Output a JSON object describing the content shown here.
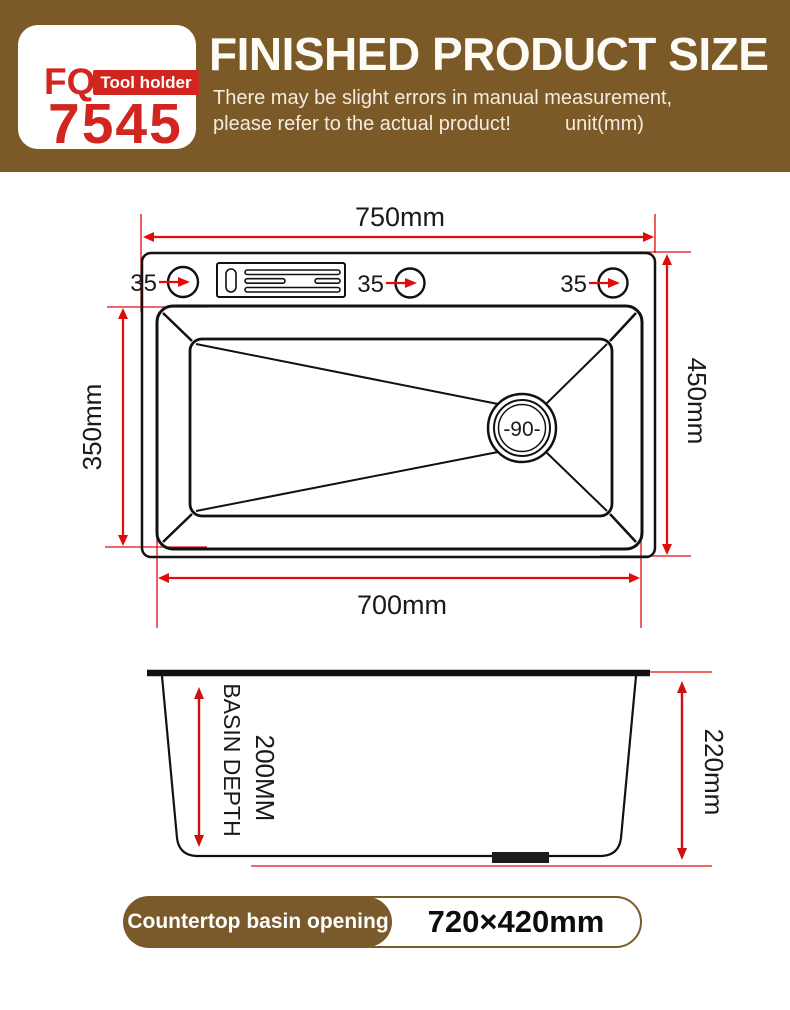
{
  "header": {
    "brand": {
      "abbr": "FQ",
      "tag": "Tool holder",
      "model": "7545"
    },
    "title": "FINISHED PRODUCT SIZE",
    "subtitle_line1": "There may be slight errors in manual measurement,",
    "subtitle_line2": "please refer to the actual product!",
    "unit": "unit(mm)"
  },
  "diagram": {
    "top_view": {
      "top_width_label": "750mm",
      "bottom_width_label": "700mm",
      "left_height_label": "350mm",
      "right_height_label": "450mm",
      "hole_labels": [
        "35",
        "35",
        "35"
      ],
      "drain_label": "-90-"
    },
    "side_view": {
      "depth_label_line1": "BASIN DEPTH",
      "depth_label_line2": "200MM",
      "overall_height_label": "220mm"
    }
  },
  "footer": {
    "badge_label": "Countertop basin opening",
    "opening_size": "720×420mm"
  },
  "colors": {
    "header_brown": "#7c5a28",
    "brand_red": "#d2251f",
    "dimension_red": "#e00c0c",
    "line_black": "#111111"
  }
}
